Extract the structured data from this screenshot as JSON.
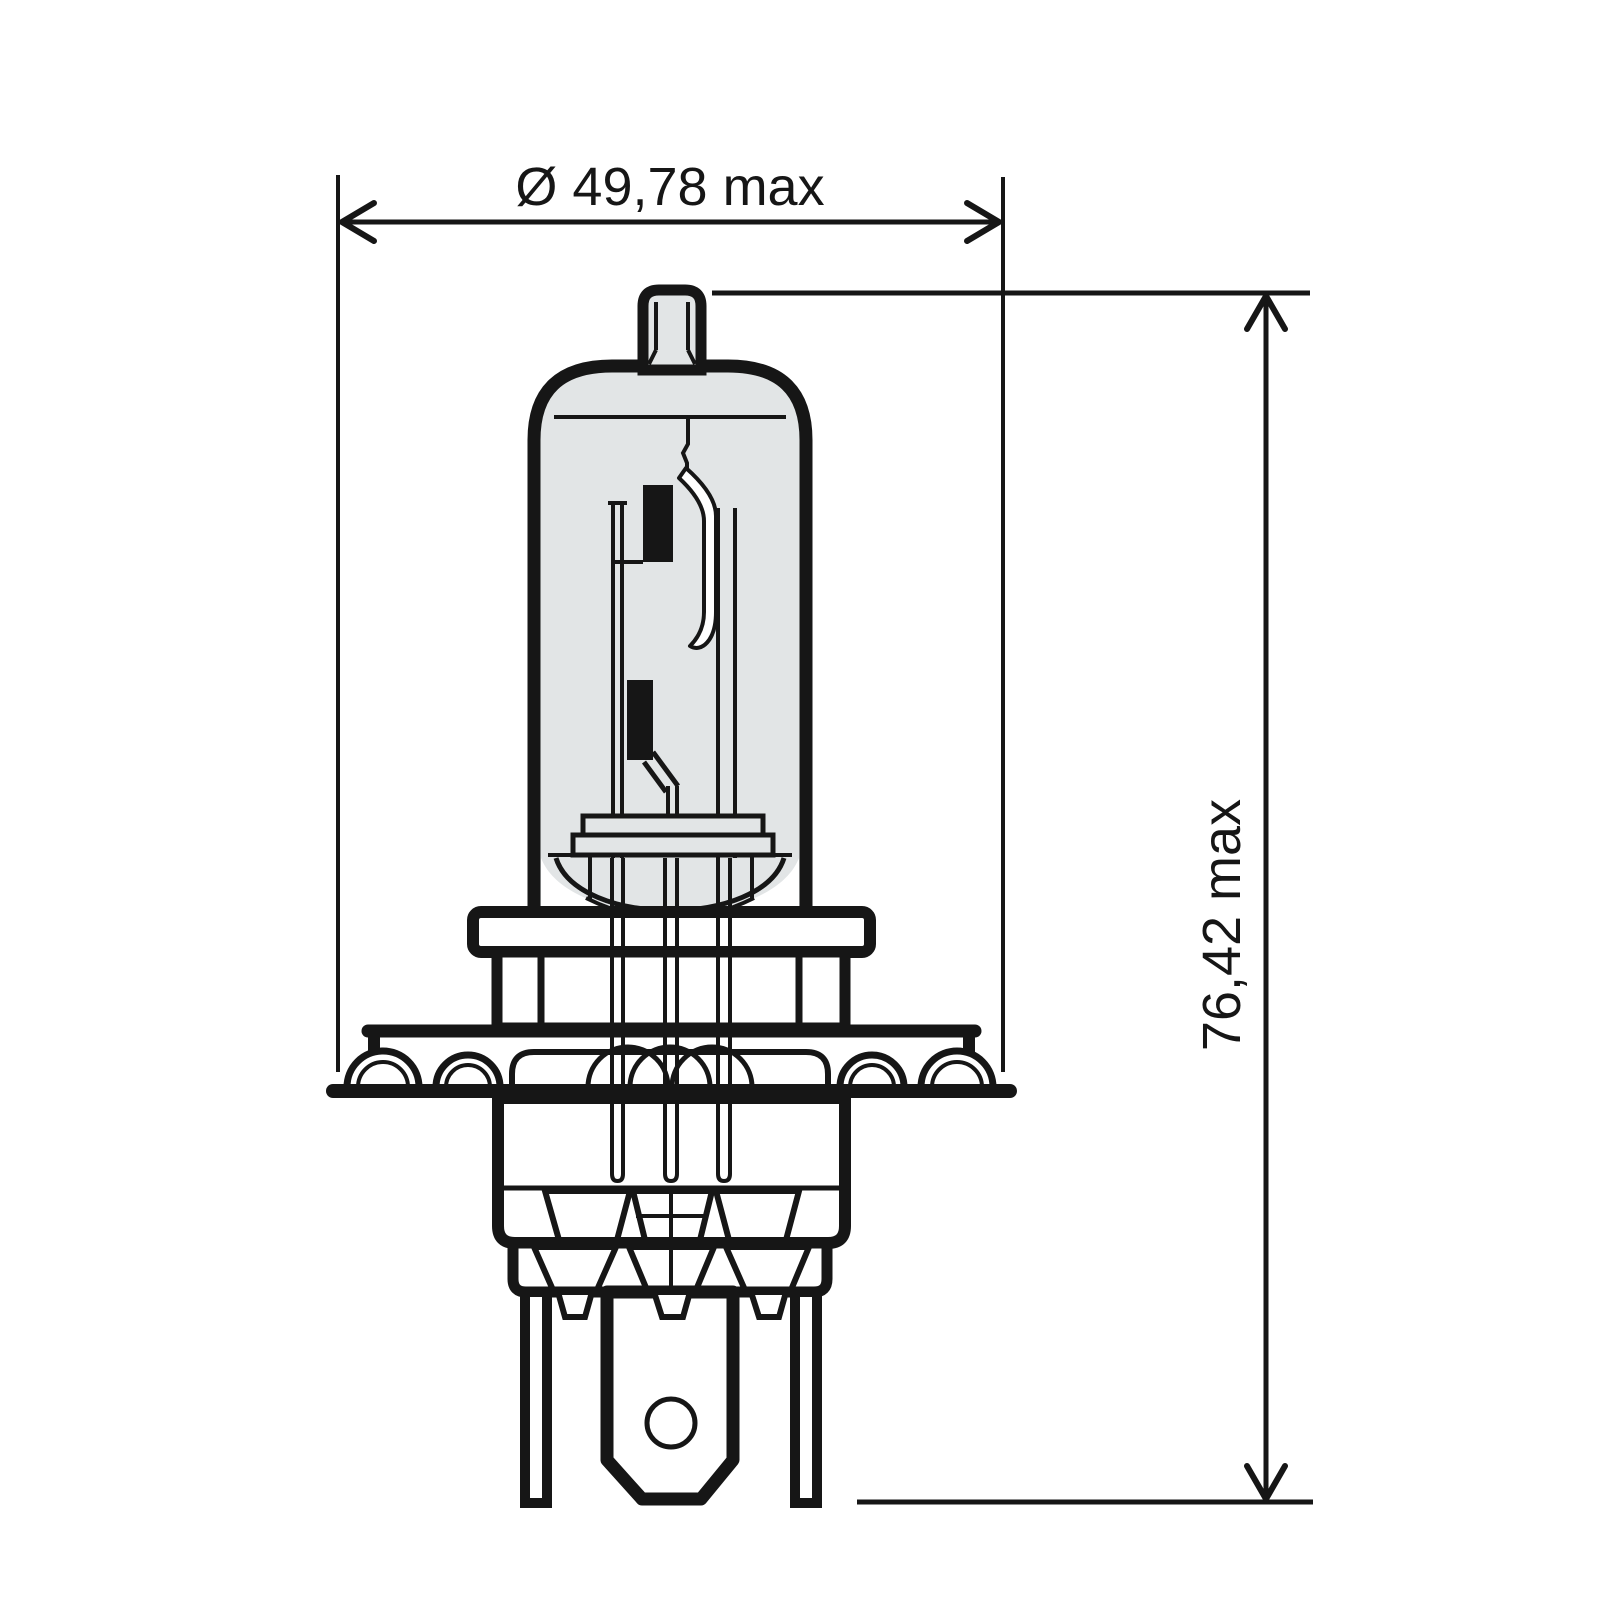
{
  "drawing": {
    "type": "technical-dimension-drawing",
    "subject": "H4 halogen headlight bulb, side elevation with internal filaments, P43t base flange and three flat terminals",
    "labels": {
      "diameter": "Ø 49,78 max",
      "length": "76,42 max"
    },
    "colors": {
      "line": "#161616",
      "glass_fill": "#e2e5e6",
      "background": "#ffffff"
    }
  }
}
